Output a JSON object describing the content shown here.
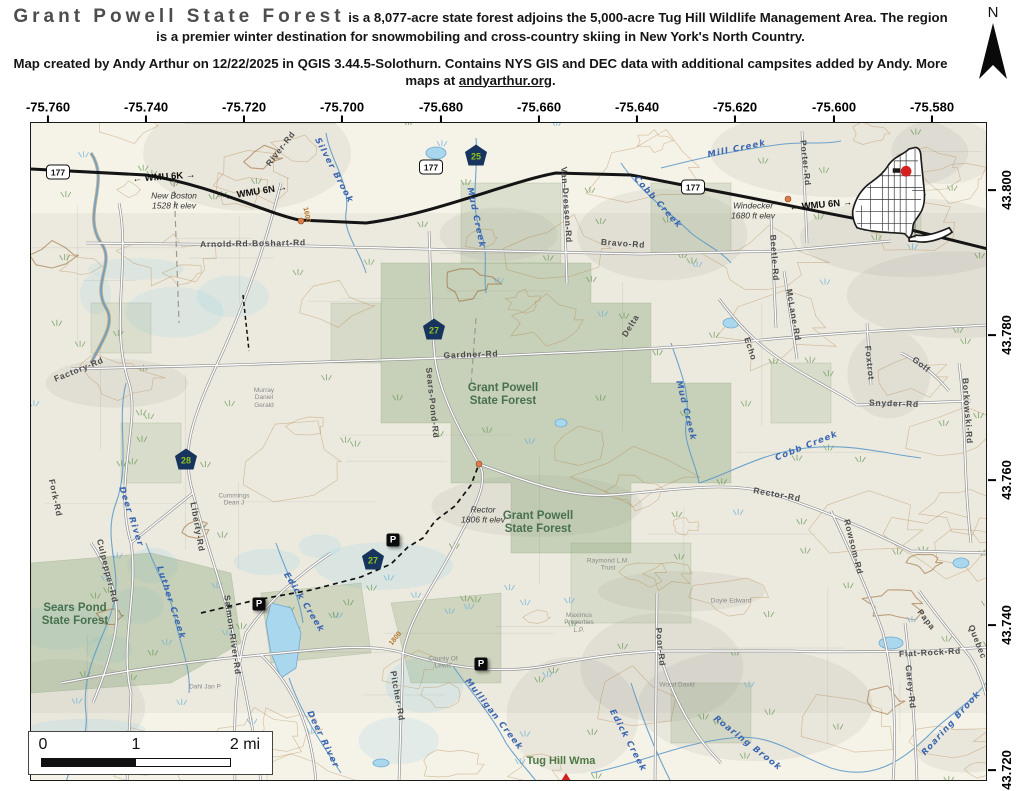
{
  "header": {
    "title": "Grant Powell State Forest",
    "description": " is a 8,077-acre state forest adjoins the 5,000-acre Tug Hill Wildlife Management Area. The region is a premier winter destination for snowmobiling and cross-country skiing in New York's North Country.",
    "credit_before_link": "Map created by Andy Arthur on 12/22/2025 in QGIS 3.44.5-Solothurn. Contains NYS GIS and DEC data with additional campsites added by Andy. More maps at ",
    "credit_link": "andyarthur.org",
    "credit_after_link": ".",
    "north_label": "N"
  },
  "axes": {
    "top": [
      {
        "label": "-75.760",
        "x": 48,
        "y": 111
      },
      {
        "label": "-75.740",
        "x": 146,
        "y": 111
      },
      {
        "label": "-75.720",
        "x": 244,
        "y": 111
      },
      {
        "label": "-75.700",
        "x": 342,
        "y": 111
      },
      {
        "label": "-75.680",
        "x": 441,
        "y": 111
      },
      {
        "label": "-75.660",
        "x": 539,
        "y": 111
      },
      {
        "label": "-75.640",
        "x": 637,
        "y": 111
      },
      {
        "label": "-75.620",
        "x": 735,
        "y": 111
      },
      {
        "label": "-75.600",
        "x": 834,
        "y": 111
      },
      {
        "label": "-75.580",
        "x": 932,
        "y": 111
      }
    ],
    "right": [
      {
        "label": "43.800",
        "x": 1001,
        "y": 190
      },
      {
        "label": "43.780",
        "x": 1001,
        "y": 335
      },
      {
        "label": "43.760",
        "x": 1001,
        "y": 480
      },
      {
        "label": "43.740",
        "x": 1001,
        "y": 625
      },
      {
        "label": "43.720",
        "x": 1001,
        "y": 770
      }
    ]
  },
  "scalebar": {
    "ticks": [
      {
        "label": "0",
        "x": 14,
        "y": 13
      },
      {
        "label": "1",
        "x": 107,
        "y": 13
      },
      {
        "label": "2 mi",
        "x": 216,
        "y": 13
      }
    ]
  },
  "map": {
    "labels": [
      {
        "text": "River-Rd",
        "x": 250,
        "y": 26,
        "rot": -52,
        "cls": "road"
      },
      {
        "text": "← WMU 6K →",
        "x": 133,
        "y": 55,
        "rot": -4,
        "cls": "wmu"
      },
      {
        "text": "← WMU 6N →",
        "x": 225,
        "y": 70,
        "rot": -9,
        "cls": "wmu"
      },
      {
        "text": "New Boston\n1528 ft elev",
        "x": 143,
        "y": 78,
        "rot": 0,
        "cls": "place"
      },
      {
        "text": "Arnold-Rd-Boshart-Rd",
        "x": 222,
        "y": 121,
        "rot": -1,
        "cls": "road"
      },
      {
        "text": "Silver Brook",
        "x": 302,
        "y": 48,
        "rot": 62,
        "cls": "water"
      },
      {
        "text": "Mud Creek",
        "x": 444,
        "y": 95,
        "rot": 78,
        "cls": "water"
      },
      {
        "text": "Mill Creek",
        "x": 706,
        "y": 27,
        "rot": -12,
        "cls": "water"
      },
      {
        "text": "Cobb Creek",
        "x": 626,
        "y": 80,
        "rot": 48,
        "cls": "water"
      },
      {
        "text": "Windecker\n1680 ft elev",
        "x": 722,
        "y": 88,
        "rot": 0,
        "cls": "place"
      },
      {
        "text": "← WMU 6N →",
        "x": 790,
        "y": 83,
        "rot": -5,
        "cls": "wmu"
      },
      {
        "text": "Porter-Rd",
        "x": 774,
        "y": 40,
        "rot": 84,
        "cls": "road"
      },
      {
        "text": "Van-Dressen-Rd",
        "x": 535,
        "y": 82,
        "rot": 86,
        "cls": "road"
      },
      {
        "text": "Bravo-Rd",
        "x": 592,
        "y": 121,
        "rot": 4,
        "cls": "road"
      },
      {
        "text": "Beetle-Rd",
        "x": 743,
        "y": 135,
        "rot": 86,
        "cls": "road"
      },
      {
        "text": "Delta",
        "x": 600,
        "y": 203,
        "rot": -58,
        "cls": "road"
      },
      {
        "text": "Echo",
        "x": 719,
        "y": 226,
        "rot": 72,
        "cls": "road"
      },
      {
        "text": "McLane-Rd",
        "x": 762,
        "y": 192,
        "rot": 80,
        "cls": "road"
      },
      {
        "text": "Foxtrot",
        "x": 838,
        "y": 240,
        "rot": 84,
        "cls": "road"
      },
      {
        "text": "Golf",
        "x": 890,
        "y": 242,
        "rot": 38,
        "cls": "road"
      },
      {
        "text": "Snyder-Rd",
        "x": 863,
        "y": 281,
        "rot": 2,
        "cls": "road"
      },
      {
        "text": "Borkowski-Rd",
        "x": 936,
        "y": 288,
        "rot": 86,
        "cls": "road"
      },
      {
        "text": "Factory-Rd",
        "x": 48,
        "y": 247,
        "rot": -22,
        "cls": "road"
      },
      {
        "text": "Gardner-Rd",
        "x": 440,
        "y": 232,
        "rot": -2,
        "cls": "road"
      },
      {
        "text": "Grant Powell\nState Forest",
        "x": 472,
        "y": 272,
        "rot": 0,
        "cls": "forest"
      },
      {
        "text": "Sears-Pond-Rd",
        "x": 401,
        "y": 280,
        "rot": 84,
        "cls": "road"
      },
      {
        "text": "Murray\nDaniel\nGerald",
        "x": 233,
        "y": 275,
        "rot": 0,
        "cls": "parcel"
      },
      {
        "text": "1600",
        "x": 275,
        "y": 92,
        "rot": 78,
        "cls": "contour-lbl"
      },
      {
        "text": "Rector\n1806 ft elev",
        "x": 452,
        "y": 392,
        "rot": 0,
        "cls": "place"
      },
      {
        "text": "Grant Powell\nState Forest",
        "x": 507,
        "y": 400,
        "rot": 0,
        "cls": "forest"
      },
      {
        "text": "Mud Creek",
        "x": 654,
        "y": 288,
        "rot": 76,
        "cls": "water"
      },
      {
        "text": "Cobb Creek",
        "x": 776,
        "y": 324,
        "rot": -22,
        "cls": "water"
      },
      {
        "text": "Rector-Rd",
        "x": 746,
        "y": 372,
        "rot": 10,
        "cls": "road"
      },
      {
        "text": "Rowsom-Rd",
        "x": 822,
        "y": 424,
        "rot": 76,
        "cls": "road"
      },
      {
        "text": "Liberty-Rd",
        "x": 166,
        "y": 404,
        "rot": 80,
        "cls": "road"
      },
      {
        "text": "Deer River",
        "x": 99,
        "y": 394,
        "rot": 72,
        "cls": "water"
      },
      {
        "text": "Cummings\nDean J",
        "x": 203,
        "y": 377,
        "rot": 0,
        "cls": "parcel"
      },
      {
        "text": "Fork-Rd",
        "x": 24,
        "y": 375,
        "rot": 78,
        "cls": "road"
      },
      {
        "text": "Culpepper-Rd",
        "x": 76,
        "y": 448,
        "rot": 76,
        "cls": "road"
      },
      {
        "text": "Sears Pond\nState Forest",
        "x": 44,
        "y": 492,
        "rot": 0,
        "cls": "forest"
      },
      {
        "text": "Luther Creek",
        "x": 139,
        "y": 480,
        "rot": 72,
        "cls": "water"
      },
      {
        "text": "Salmon-River-Rd",
        "x": 201,
        "y": 512,
        "rot": 82,
        "cls": "road"
      },
      {
        "text": "Edick Creek",
        "x": 272,
        "y": 480,
        "rot": 58,
        "cls": "water"
      },
      {
        "text": "1800",
        "x": 365,
        "y": 516,
        "rot": -52,
        "cls": "contour-lbl"
      },
      {
        "text": "Pitcher-Rd",
        "x": 366,
        "y": 573,
        "rot": 80,
        "cls": "road"
      },
      {
        "text": "Deer River",
        "x": 291,
        "y": 617,
        "rot": 64,
        "cls": "water"
      },
      {
        "text": "Dahl Jan P",
        "x": 174,
        "y": 564,
        "rot": 0,
        "cls": "parcel"
      },
      {
        "text": "County Of\nLewis",
        "x": 412,
        "y": 540,
        "rot": 0,
        "cls": "parcel"
      },
      {
        "text": "Mulligan Creek",
        "x": 462,
        "y": 592,
        "rot": 52,
        "cls": "water"
      },
      {
        "text": "Tug Hill Wma",
        "x": 530,
        "y": 638,
        "rot": 0,
        "cls": "wma"
      },
      {
        "text": "Edick Creek",
        "x": 596,
        "y": 618,
        "rot": 62,
        "cls": "water"
      },
      {
        "text": "Poor-Rd",
        "x": 629,
        "y": 524,
        "rot": 84,
        "cls": "road"
      },
      {
        "text": "Maximus\nProperties\nL.P.",
        "x": 548,
        "y": 500,
        "rot": 0,
        "cls": "parcel"
      },
      {
        "text": "Raymond L.M.\nTrust",
        "x": 577,
        "y": 442,
        "rot": 0,
        "cls": "parcel"
      },
      {
        "text": "Doyle Edward",
        "x": 700,
        "y": 478,
        "rot": 0,
        "cls": "parcel"
      },
      {
        "text": "Wood David",
        "x": 646,
        "y": 562,
        "rot": 0,
        "cls": "parcel"
      },
      {
        "text": "Flat-Rock-Rd",
        "x": 899,
        "y": 530,
        "rot": -3,
        "cls": "road"
      },
      {
        "text": "Papa",
        "x": 895,
        "y": 497,
        "rot": 52,
        "cls": "road"
      },
      {
        "text": "Quebec",
        "x": 946,
        "y": 519,
        "rot": 68,
        "cls": "road"
      },
      {
        "text": "Carey-Rd",
        "x": 879,
        "y": 564,
        "rot": 84,
        "cls": "road"
      },
      {
        "text": "Roaring Brook",
        "x": 716,
        "y": 621,
        "rot": 38,
        "cls": "water"
      },
      {
        "text": "Roaring Brook",
        "x": 921,
        "y": 601,
        "rot": -48,
        "cls": "water"
      }
    ],
    "state_routes": [
      {
        "num": "177",
        "x": 27,
        "y": 49
      },
      {
        "num": "177",
        "x": 400,
        "y": 44
      },
      {
        "num": "177",
        "x": 662,
        "y": 64
      }
    ],
    "county_routes": [
      {
        "num": "25",
        "x": 445,
        "y": 32
      },
      {
        "num": "27",
        "x": 403,
        "y": 206
      },
      {
        "num": "28",
        "x": 155,
        "y": 336
      },
      {
        "num": "27",
        "x": 342,
        "y": 436
      }
    ],
    "parking": [
      {
        "label": "P",
        "x": 362,
        "y": 417
      },
      {
        "label": "P",
        "x": 228,
        "y": 481
      },
      {
        "label": "P",
        "x": 450,
        "y": 541
      }
    ]
  },
  "inset": {
    "marker_color": "#d42020"
  },
  "colors": {
    "forest_fill": "#93a87c",
    "water": "#5f9bc8",
    "contour": "#ba7a3c",
    "highway": "#141414",
    "county_shield_bg": "#17345f",
    "county_shield_text": "#8fc31f"
  }
}
